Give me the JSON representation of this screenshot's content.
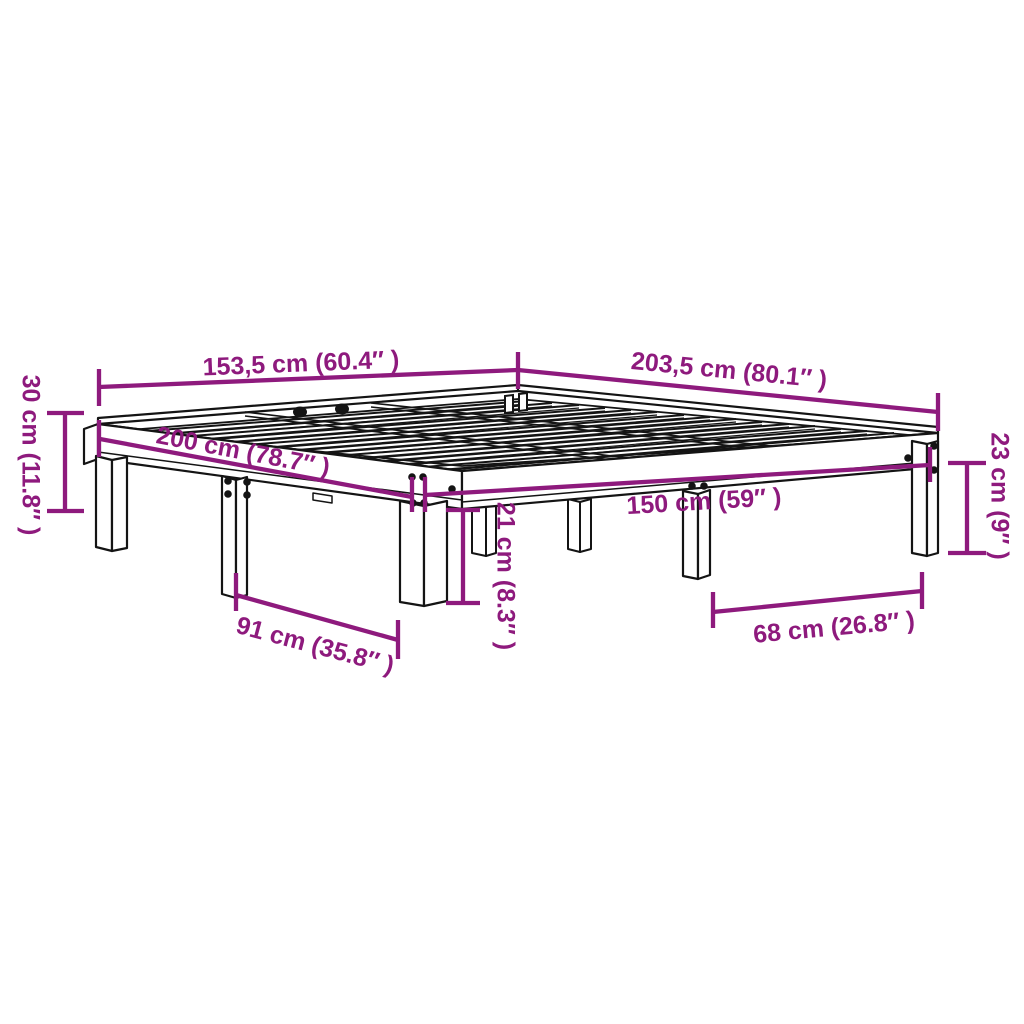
{
  "page": {
    "background_color": "#ffffff",
    "dimension_color": "#8e1a7d",
    "line_art_color": "#141414"
  },
  "diagram": {
    "subject": "wooden-bed-frame-with-slatted-base",
    "dimensions": [
      {
        "id": "overall-width",
        "label": "153,5 cm (60.4″ )"
      },
      {
        "id": "overall-length",
        "label": "203,5 cm (80.1″ )"
      },
      {
        "id": "frame-height",
        "label": "30 cm (11.8″ )"
      },
      {
        "id": "inner-length",
        "label": "200 cm (78.7″ )"
      },
      {
        "id": "inner-width",
        "label": "150 cm (59″ )"
      },
      {
        "id": "side-rail-height",
        "label": "23 cm (9″ )"
      },
      {
        "id": "leg-clearance",
        "label": "21 cm (8.3″ )"
      },
      {
        "id": "leg-span-side",
        "label": "91 cm (35.8″ )"
      },
      {
        "id": "leg-span-front",
        "label": "68 cm (26.8″ )"
      }
    ]
  }
}
